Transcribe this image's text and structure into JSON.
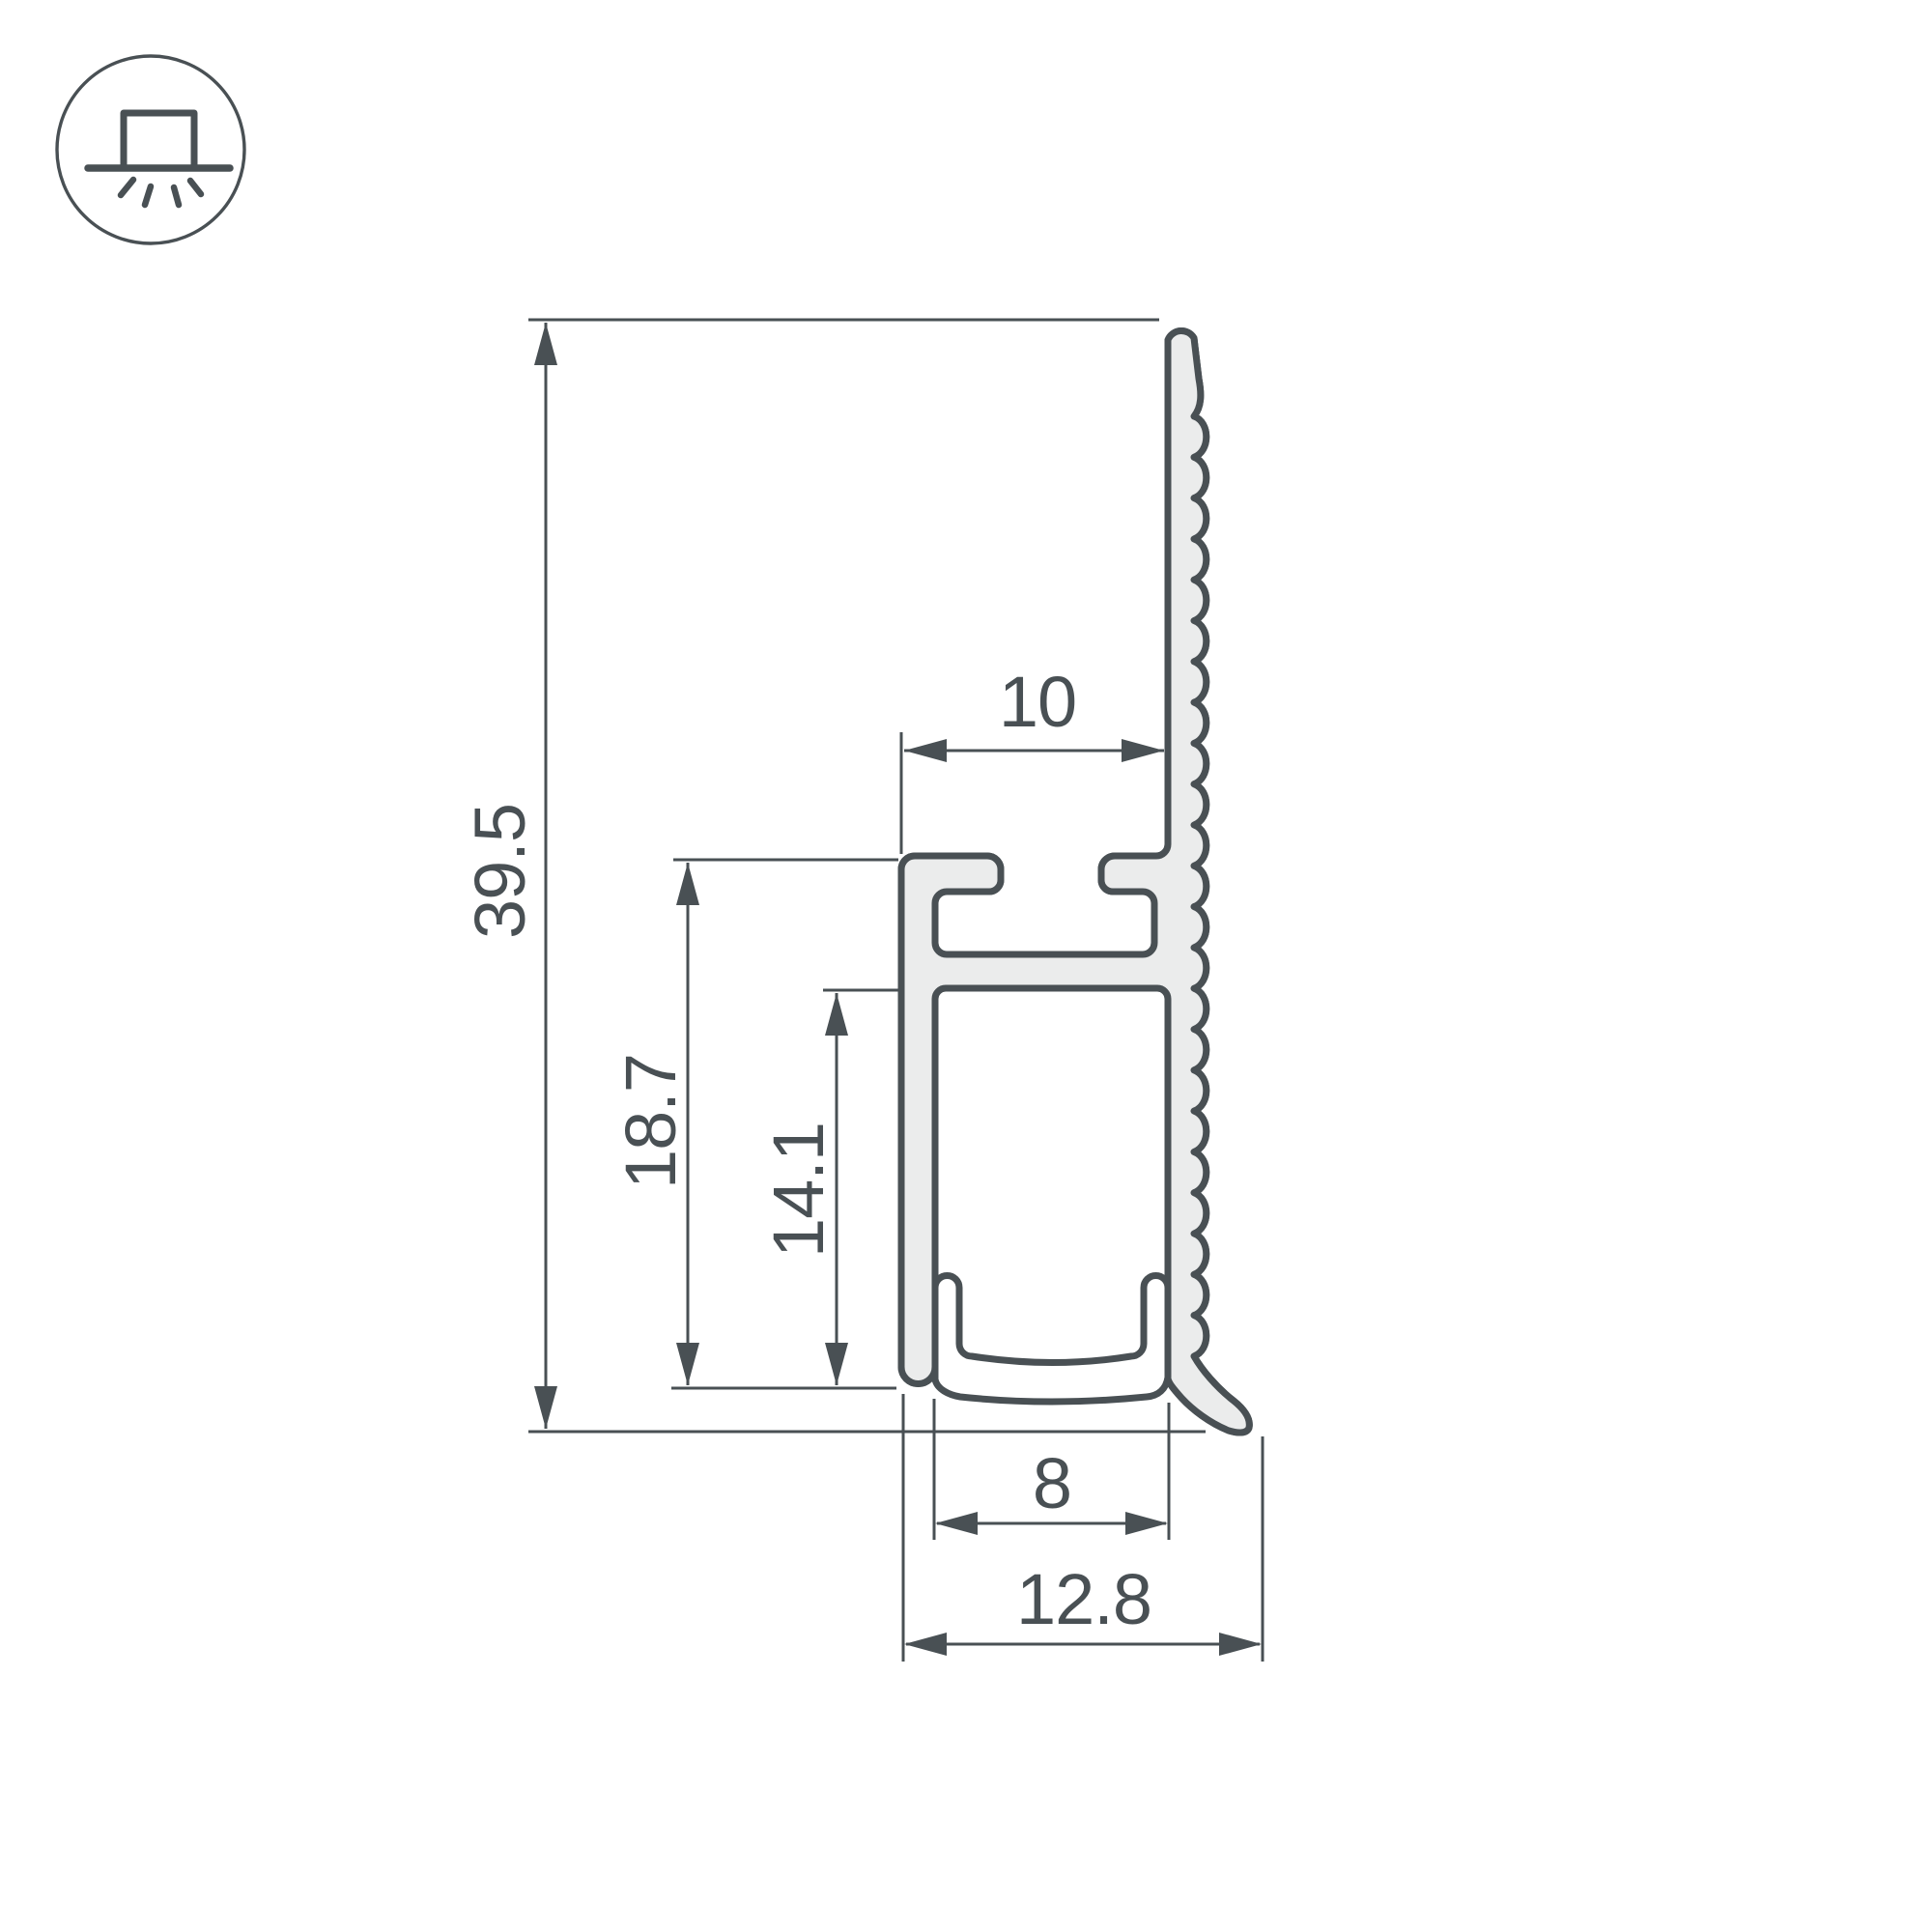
{
  "drawing": {
    "title": "led-profile-cross-section",
    "icon": "surface-mount-light-icon",
    "dimensions": {
      "total_height": "39.5",
      "body_height": "18.7",
      "channel_inner_height": "14.1",
      "top_slot_depth": "10",
      "channel_inner_width": "8",
      "overall_depth": "12.8"
    },
    "colors": {
      "line": "#495054",
      "profile_fill": "#ebecec",
      "background": "#ffffff"
    }
  }
}
